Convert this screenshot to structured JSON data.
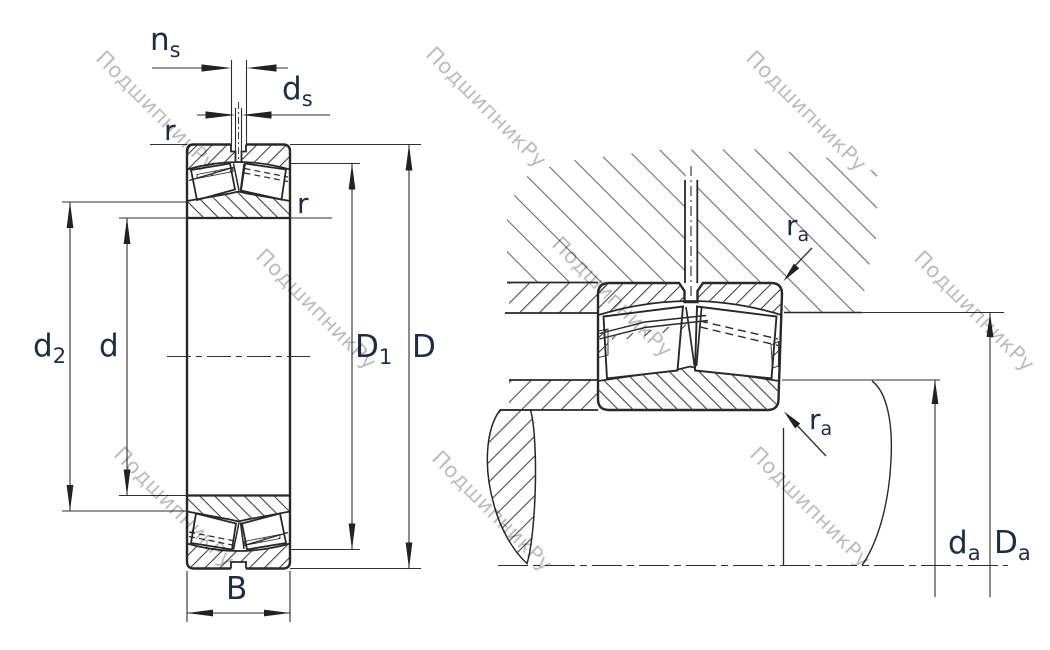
{
  "watermark": {
    "text": "ПодшипникРу",
    "color": "#bdbdbd"
  },
  "colors": {
    "line": "#282828",
    "label_text": "#1d2e44",
    "hatch_fine": "#3d3d3d",
    "hatch_housing": "#6e6e6e",
    "background": "#ffffff"
  },
  "left_view": {
    "title": "bearing-cross-section",
    "labels": {
      "ns": {
        "main": "n",
        "sub": "s"
      },
      "ds": {
        "main": "d",
        "sub": "s"
      },
      "r_outer": "r",
      "r_inner": "r",
      "d2": {
        "main": "d",
        "sub": "2"
      },
      "d": "d",
      "D1": {
        "main": "D",
        "sub": "1"
      },
      "D": "D",
      "B": "B"
    }
  },
  "right_view": {
    "title": "mounting-cross-section",
    "labels": {
      "ra_top": {
        "main": "r",
        "sub": "a"
      },
      "ra_bottom": {
        "main": "r",
        "sub": "a"
      },
      "da": {
        "main": "d",
        "sub": "a"
      },
      "Da": {
        "main": "D",
        "sub": "a"
      }
    }
  }
}
